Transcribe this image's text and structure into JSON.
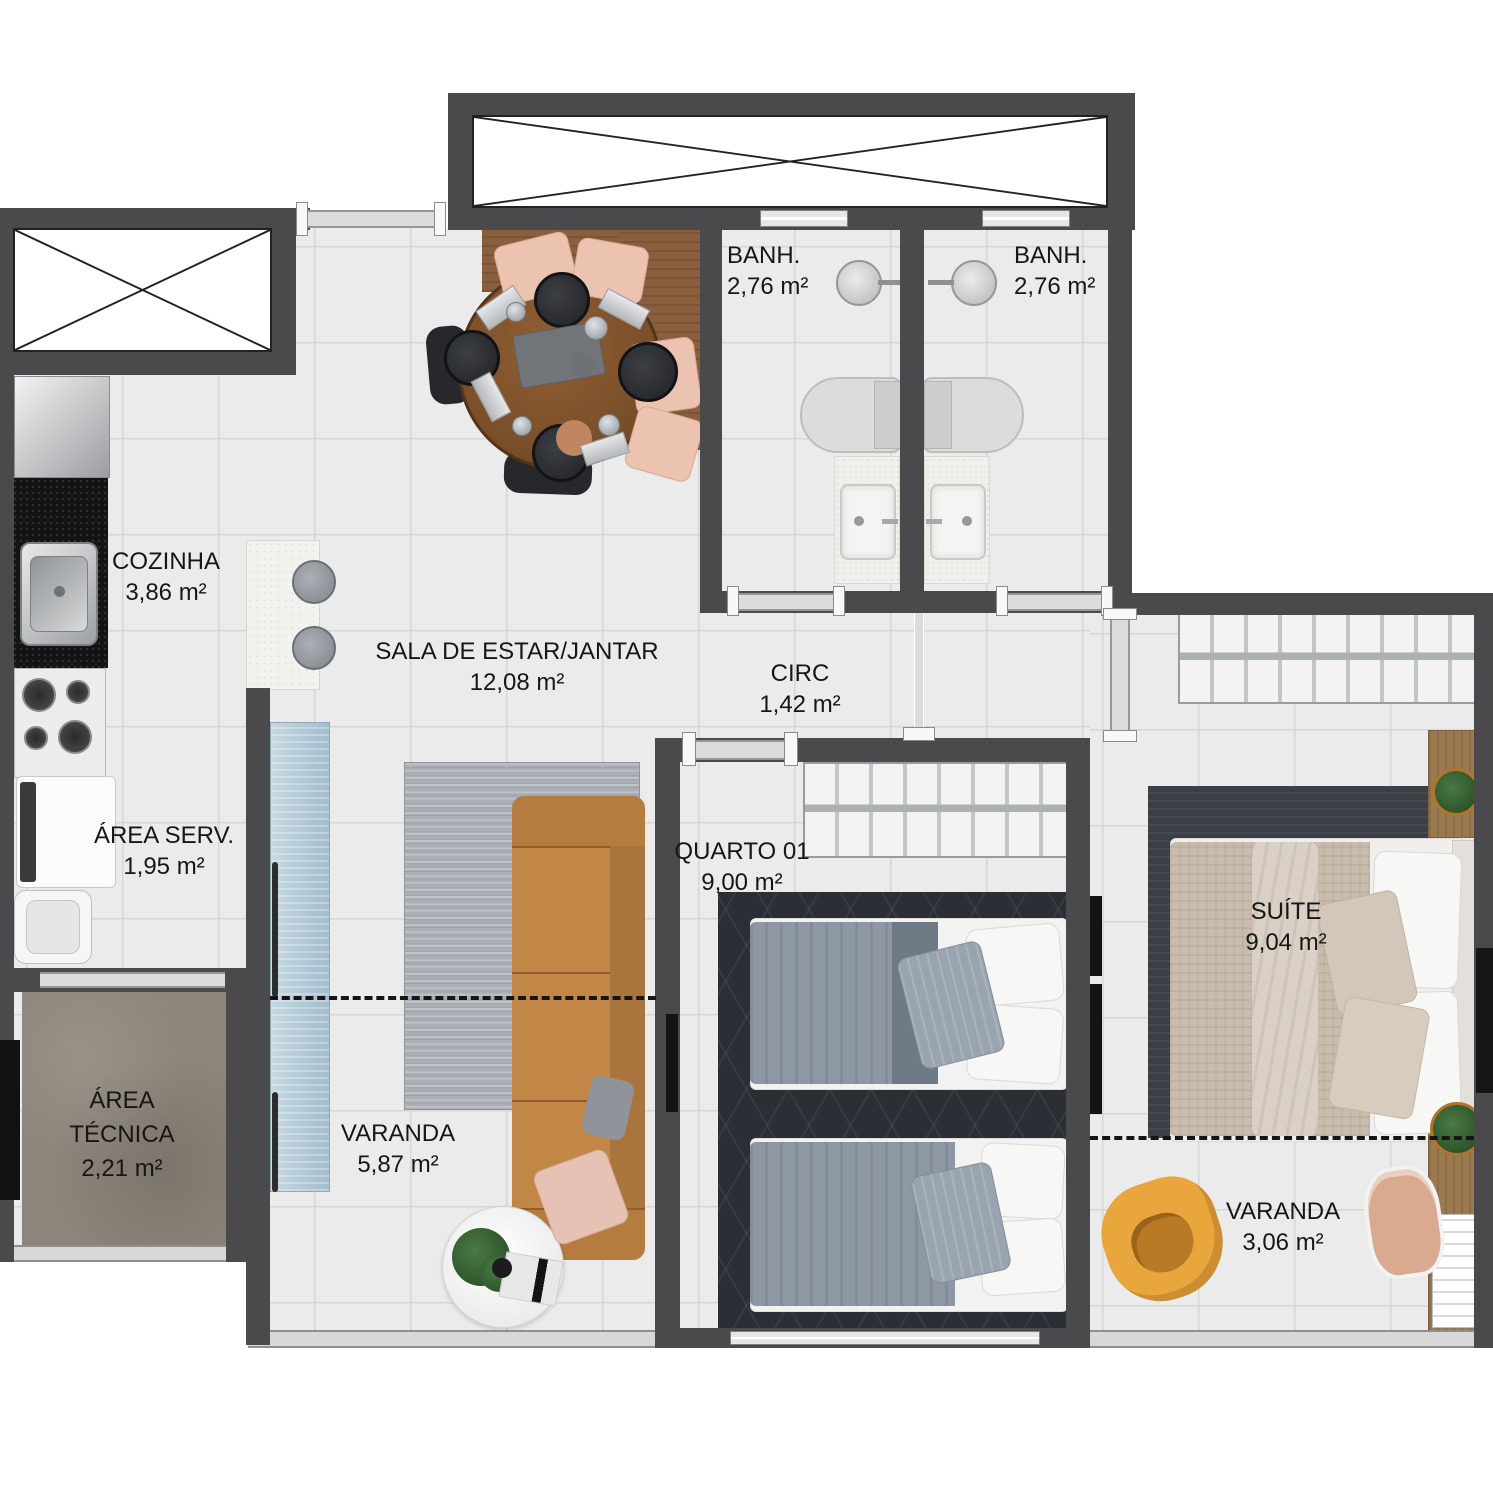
{
  "rooms": {
    "bathroom_1": {
      "name": "BANH.",
      "area": "2,76 m²"
    },
    "bathroom_2": {
      "name": "BANH.",
      "area": "2,76 m²"
    },
    "kitchen": {
      "name": "COZINHA",
      "area": "3,86 m²"
    },
    "living_dining": {
      "name": "SALA DE ESTAR/JANTAR",
      "area": "12,08 m²"
    },
    "circulation": {
      "name": "CIRC",
      "area": "1,42 m²"
    },
    "service_area": {
      "name": "ÁREA SERV.",
      "area": "1,95 m²"
    },
    "technical_area": {
      "name_line1": "ÁREA",
      "name_line2": "TÉCNICA",
      "area": "2,21 m²"
    },
    "balcony_living": {
      "name": "VARANDA",
      "area": "5,87 m²"
    },
    "bedroom_1": {
      "name": "QUARTO 01",
      "area": "9,00 m²"
    },
    "suite": {
      "name": "SUÍTE",
      "area": "9,04 m²"
    },
    "balcony_suite": {
      "name": "VARANDA",
      "area": "3,06 m²"
    }
  },
  "colors": {
    "wall": "#4a4a4c",
    "floor_tile": "#ebebeb",
    "technical_floor": "#8d857b",
    "sofa_tan": "#c28747",
    "cabinet_blue": "#b4c9d7",
    "armchair_yellow": "#e8a63c",
    "wood": "#8a5f3d",
    "bedroom_rug_dark": "#2b2f35",
    "living_rug_gray": "#a9afb5",
    "suite_bed_beige": "#c9bcad"
  }
}
